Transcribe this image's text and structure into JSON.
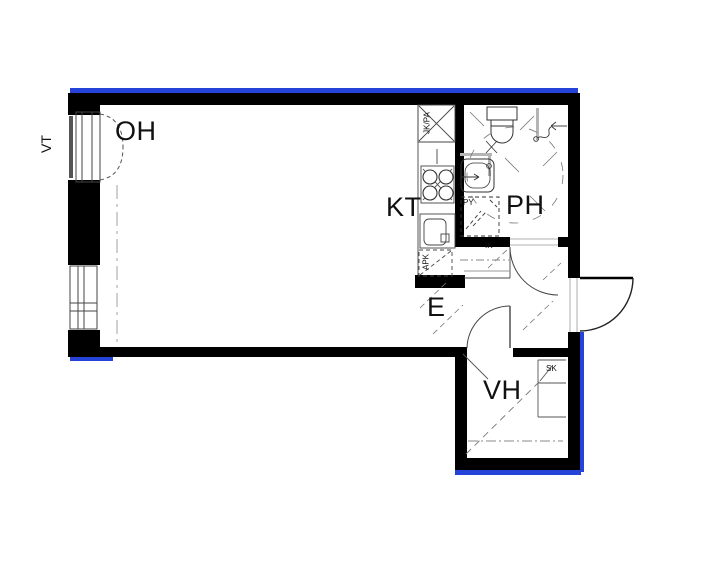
{
  "plan": {
    "rooms": {
      "living": "OH",
      "kitchen": "KT",
      "bathroom": "PH",
      "entry": "E",
      "walk_in_closet": "VH"
    },
    "markers": {
      "balcony_door": "VT",
      "fridge_freezer": "JK/PA",
      "dishwasher": "APK",
      "laundry_reservation": "PY",
      "entry_closet": "IK",
      "cleaning_cupboard": "SK"
    },
    "colors": {
      "wall": "#000000",
      "exterior_edge": "#2542d9",
      "thin_line": "#444444",
      "hatch_line": "#777777"
    }
  }
}
